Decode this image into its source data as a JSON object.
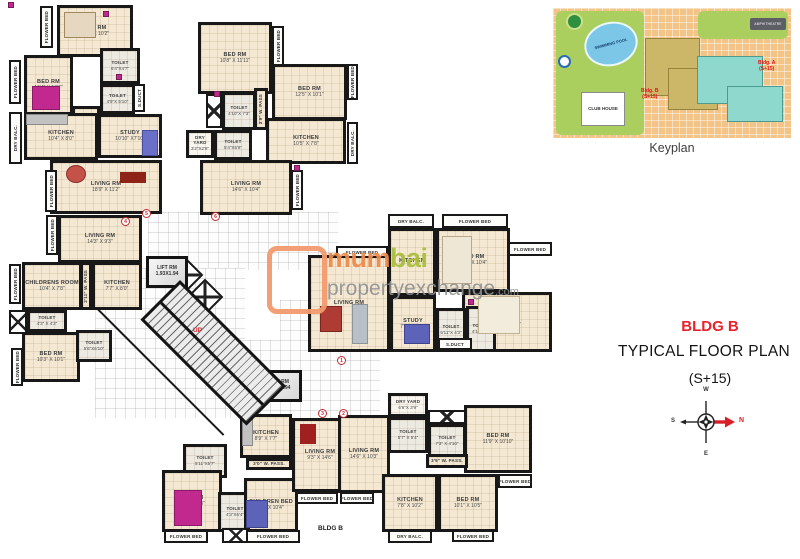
{
  "title": {
    "bldg": "BLDG B",
    "plan": "TYPICAL FLOOR PLAN",
    "floors": "(S+15)"
  },
  "keyplan": {
    "caption": "Keyplan",
    "pool": "SWIMMING POOL",
    "club": "CLUB HOUSE",
    "amphi": "AMPHITHEATRE",
    "bldg_b_l1": "Bldg. B",
    "bldg_b_l2": "(S+15)",
    "bldg_a_l1": "Bldg. A",
    "bldg_a_l2": "(S+15)"
  },
  "compass": {
    "n": "N",
    "s": "S",
    "e": "E",
    "w": "W"
  },
  "watermark": {
    "brand_a": "mum",
    "brand_b": "bai",
    "domain": "propertyexchange",
    "tld": ".com"
  },
  "strings": {
    "flower_bed": "FLOWER BED",
    "dry_balc": "DRY BALC.",
    "s_duct": "S.DUCT",
    "up": "UP",
    "lift": "LIFT RM",
    "lift_dims": "1.93X1.94",
    "bldg_b_small": "BLDG B"
  },
  "doors": {
    "n1": "1",
    "n2": "2",
    "n3": "3",
    "n4": "4",
    "n5": "5",
    "n6": "6"
  },
  "rooms": {
    "a1bed1": {
      "name": "BED RM",
      "dims": "13'2\" X 10'2\""
    },
    "a1bed2": {
      "name": "BED RM",
      "dims": "10'4\" X 10'7\""
    },
    "a1toilet1": {
      "name": "TOILET",
      "dims": "6'4\"X4'7\""
    },
    "a1toilet2": {
      "name": "TOILET",
      "dims": "4'9\"X 5'10\""
    },
    "a1pass": {
      "name": "PASS",
      "dims": "3'9\" W."
    },
    "a1study": {
      "name": "STUDY",
      "dims": "10'10\" X7'10\""
    },
    "a1kitchen": {
      "name": "KITCHEN",
      "dims": "10'4\" X 8'0\""
    },
    "a1living": {
      "name": "LIVING RM",
      "dims": "18'9\" X 11'2\""
    },
    "a2bed1": {
      "name": "BED RM",
      "dims": "10'8\" X 11'11\""
    },
    "a2bed2": {
      "name": "BED RM",
      "dims": "12'5\" X 10'1\""
    },
    "a2toilet1": {
      "name": "TOILET",
      "dims": "4'10\"X 7'3\""
    },
    "a2toilet2": {
      "name": "TOILET",
      "dims": "5'4\"X5'9\""
    },
    "a2dryyard": {
      "name": "DRY YARD",
      "dims": "3'2\"X2'9\""
    },
    "a2kitchen": {
      "name": "KITCHEN",
      "dims": "10'5\" X 7'8\""
    },
    "a2living": {
      "name": "LIVING RM",
      "dims": "14'6\" X 10'4\""
    },
    "a2pass": {
      "name": "3'9\" W. PASS"
    },
    "a3living": {
      "name": "LIVING RM",
      "dims": "14'3\" X 9'3\""
    },
    "a3children": {
      "name": "CHILDRENS ROOM",
      "dims": "10'4\" X 7'8\""
    },
    "a3kitchen": {
      "name": "KITCHEN",
      "dims": "7'7\" X 8'0\""
    },
    "a3pass": {
      "name": "2'11\" W. PASS"
    },
    "a3toilet1": {
      "name": "TOILET",
      "dims": "4'3\" X 4'3\""
    },
    "a3toilet2": {
      "name": "TOILET",
      "dims": "5'6\"X6'10\""
    },
    "a3bed": {
      "name": "BED RM",
      "dims": "10'3\" X 10'1\""
    },
    "a4kitchen": {
      "name": "KITCHEN",
      "dims": ""
    },
    "a4bed1": {
      "name": "BED RM",
      "dims": "10'7\" X 10'4\""
    },
    "a4bed2": {
      "name": "BED RM",
      "dims": "10'0\" X 13'2\""
    },
    "a4living": {
      "name": "LIVING RM",
      "dims": ""
    },
    "a4study": {
      "name": "STUDY",
      "dims": "7'10\"X10'9\""
    },
    "a4toilet1": {
      "name": "TOILET",
      "dims": "5'11\"X 4'3\""
    },
    "a4toilet2": {
      "name": "TOILET",
      "dims": "4'1\"X6'5\""
    },
    "a5kitchen": {
      "name": "KITCHEN",
      "dims": "8'9\" X 7'7\""
    },
    "a5pass": {
      "name": "3'0\" W. PASS."
    },
    "a5toilet1": {
      "name": "TOILET",
      "dims": "5'11\"X5'7\""
    },
    "a5bed": {
      "name": "BED RM",
      "dims": "10'1\"X10'3\""
    },
    "a5toilet2": {
      "name": "TOILET",
      "dims": "4'3\"X6'4\""
    },
    "a5children": {
      "name": "CHILDREN BED",
      "dims": "7'6\" X 10'4\""
    },
    "a5living": {
      "name": "LIVING RM",
      "dims": "9'3\" X 14'6\""
    },
    "a6dryyard": {
      "name": "DRY YARD",
      "dims": "6'6\"X 3'9\""
    },
    "a6toilet1": {
      "name": "TOILET",
      "dims": "5'7\" X 5'4\""
    },
    "a6toilet2": {
      "name": "TOILET",
      "dims": "7'3\" X 4'10\""
    },
    "a6bed1": {
      "name": "BED RM",
      "dims": "11'9\" X 10'10\""
    },
    "a6living": {
      "name": "LIVING RM",
      "dims": "14'6\" X 10'3\""
    },
    "a6pass": {
      "name": "3'9\" W. PASS."
    },
    "a6kitchen": {
      "name": "KITCHEN",
      "dims": "7'8\" X 10'2\""
    },
    "a6bed2": {
      "name": "BED RM",
      "dims": "10'1\" X 10'5\""
    }
  }
}
